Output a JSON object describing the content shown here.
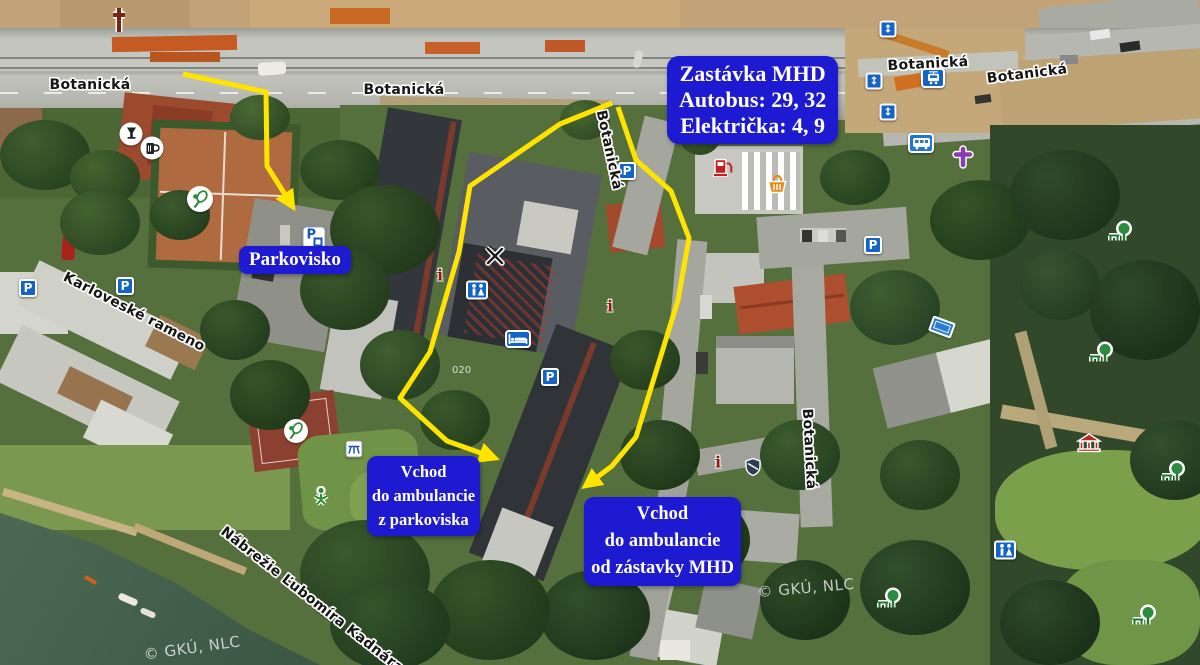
{
  "map": {
    "copyright": "© GKÚ, NLC",
    "building_number": "020",
    "streets": {
      "botanicka": "Botanická",
      "karloveske_rameno": "Karloveské rameno",
      "nabrezie": "Nábrežie Ľubomíra Kadnára"
    },
    "callouts": {
      "mhd_stop": {
        "line1": "Zastávka MHD",
        "line2": "Autobus: 29, 32",
        "line3": "Električka: 4, 9"
      },
      "parking": "Parkovisko",
      "entrance_from_parking": {
        "line1": "Vchod",
        "line2": "do ambulancie",
        "line3": "z parkoviska"
      },
      "entrance_from_mhd": {
        "line1": "Vchod",
        "line2": "do ambulancie",
        "line3": "od zástavky MHD"
      }
    },
    "icon_glyphs": {
      "parking": "P",
      "info": "i",
      "updown": "↕"
    },
    "colors": {
      "callout_blue": "#1d1ad2",
      "route_yellow": "#ffe400",
      "icon_blue": "#1464c8"
    }
  }
}
